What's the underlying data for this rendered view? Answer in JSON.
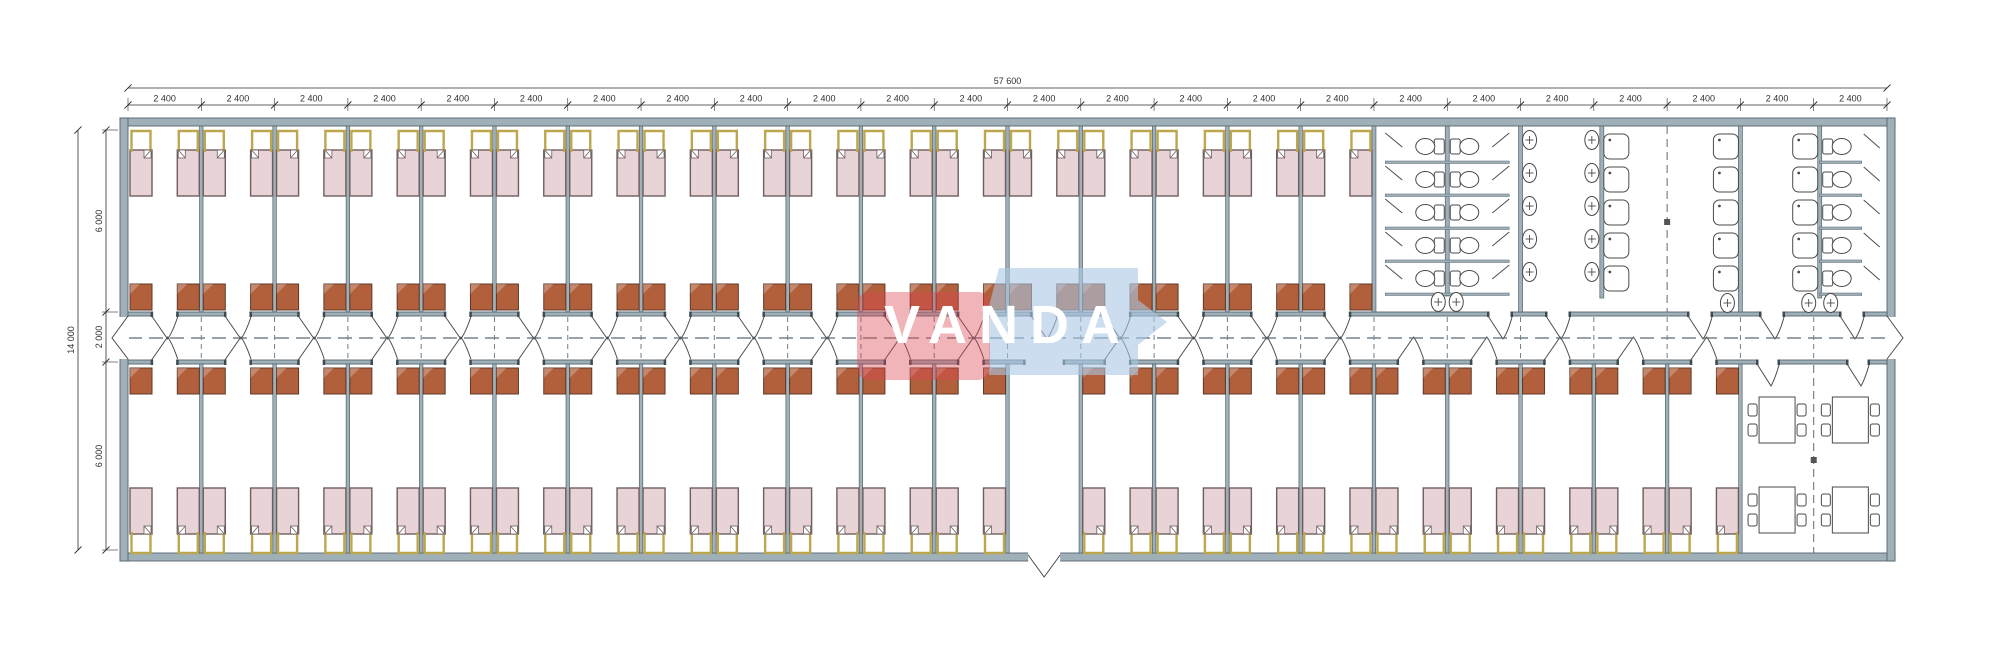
{
  "drawing": {
    "type": "architectural floor plan",
    "description": "Modular dormitory building: central corridor, mirrored bedroom modules with beds and wardrobes, sanitary block (WC stalls, wash basins, showers) top right, dining room bottom right",
    "canvas": {
      "width": 2000,
      "height": 654
    }
  },
  "watermark": {
    "text": "VANDA",
    "red_color": "rgba(219,70,80,0.40)",
    "blue_color": "rgba(168,199,226,0.60)",
    "text_color": "#ffffff"
  },
  "dimensions": {
    "top": {
      "total_label": "57 600",
      "segment_labels": [
        "2 400",
        "2 400",
        "2 400",
        "2 400",
        "2 400",
        "2 400",
        "2 400",
        "2 400",
        "2 400",
        "2 400",
        "2 400",
        "2 400",
        "2 400",
        "2 400",
        "2 400",
        "2 400",
        "2 400",
        "2 400",
        "2 400",
        "2 400",
        "2 400",
        "2 400",
        "2 400",
        "2 400"
      ]
    },
    "left": {
      "total_label": "14 000",
      "segment_labels": [
        "6 000",
        "2 000",
        "6 000"
      ]
    }
  },
  "layout": {
    "modules_total": 24,
    "module_width_mm": 2400,
    "building_width_mm": 57600,
    "building_depth_mm": 14000,
    "corridor_depth_mm": 2000,
    "room_depth_mm": 6000,
    "bedrooms_top": 17,
    "bedrooms_bottom": 21,
    "beds_per_room": 2,
    "wardrobes_per_room": 2,
    "entrance_module_index": 12,
    "sanitary": {
      "wc_stall_rows": 5,
      "wc_double_block_toilets": 10,
      "wc_right_column_toilets": 5,
      "wash_basins": 15,
      "shower_trays": 15
    },
    "dining": {
      "tables": 4,
      "chairs_per_table": 4
    }
  },
  "colors": {
    "wall_fill": "#9fb0b8",
    "wall_stroke": "#55646e",
    "bed_fill": "#e8d3d7",
    "bed_stroke": "#6f5e5e",
    "headboard": "#bda74e",
    "wardrobe_fill": "#b2603c",
    "wardrobe_stroke": "#5e3a28",
    "fixture_stroke": "#4a4a4a",
    "door_stroke": "#4d4d4d",
    "dash": "#6f7d86",
    "centerline": "#5c6b74",
    "dimension": "#2f2f2f",
    "background": "#ffffff"
  }
}
